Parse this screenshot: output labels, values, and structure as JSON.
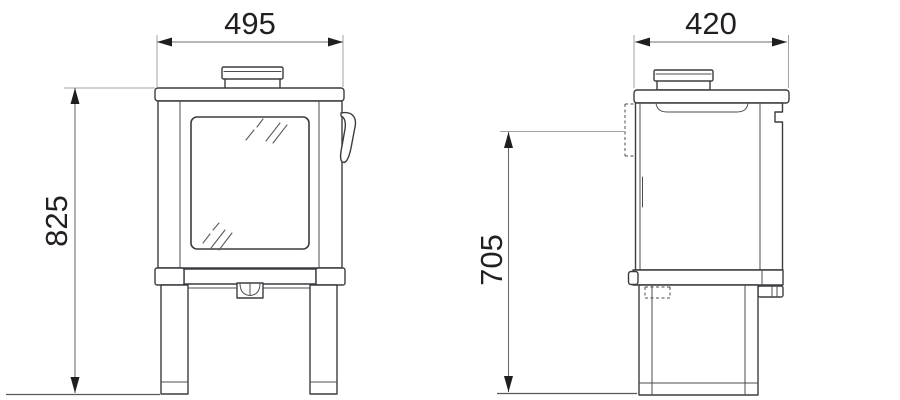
{
  "diagram": {
    "type": "technical-dimension-drawing",
    "subject": "wood-burning stove shown in front elevation and side elevation with millimetre dimensions",
    "views": {
      "front": {
        "width_label": "495",
        "height_label": "825"
      },
      "side": {
        "depth_label": "420",
        "height_label": "705"
      }
    },
    "colors": {
      "background": "#ffffff",
      "outline": "#3a3d40",
      "dimension_line": "#6b6e71",
      "extension_line": "#9fa3a6",
      "arrowhead": "#1f1f1f",
      "label_text": "#231f20"
    }
  }
}
